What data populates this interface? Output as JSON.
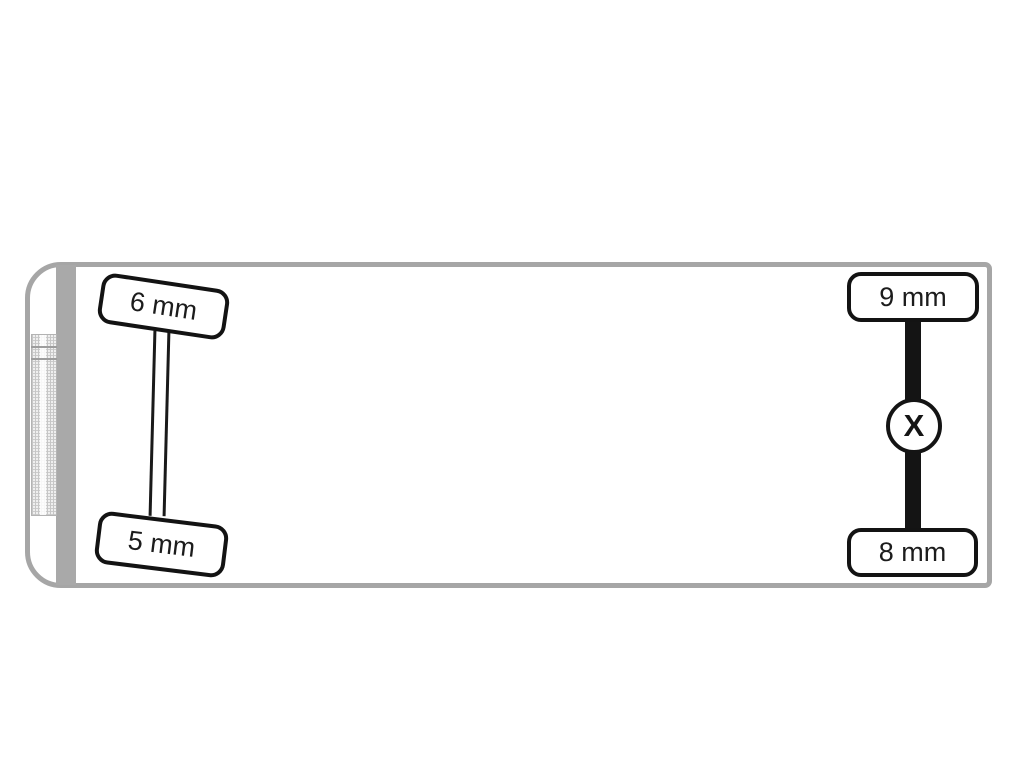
{
  "diagram": {
    "type": "vehicle-top-view-tire-tread",
    "wheels": {
      "front_top": {
        "label": "6 mm"
      },
      "front_bottom": {
        "label": "5 mm"
      },
      "rear_top": {
        "label": "9 mm"
      },
      "rear_bottom": {
        "label": "8 mm"
      }
    },
    "rear_axle_marker": "X",
    "colors": {
      "background": "#ffffff",
      "body_outline": "#a6a6a6",
      "cab_divider": "#a9a9a9",
      "wheel_border": "#131313",
      "axle": "#141414",
      "label_text": "#1c1c1c"
    }
  }
}
